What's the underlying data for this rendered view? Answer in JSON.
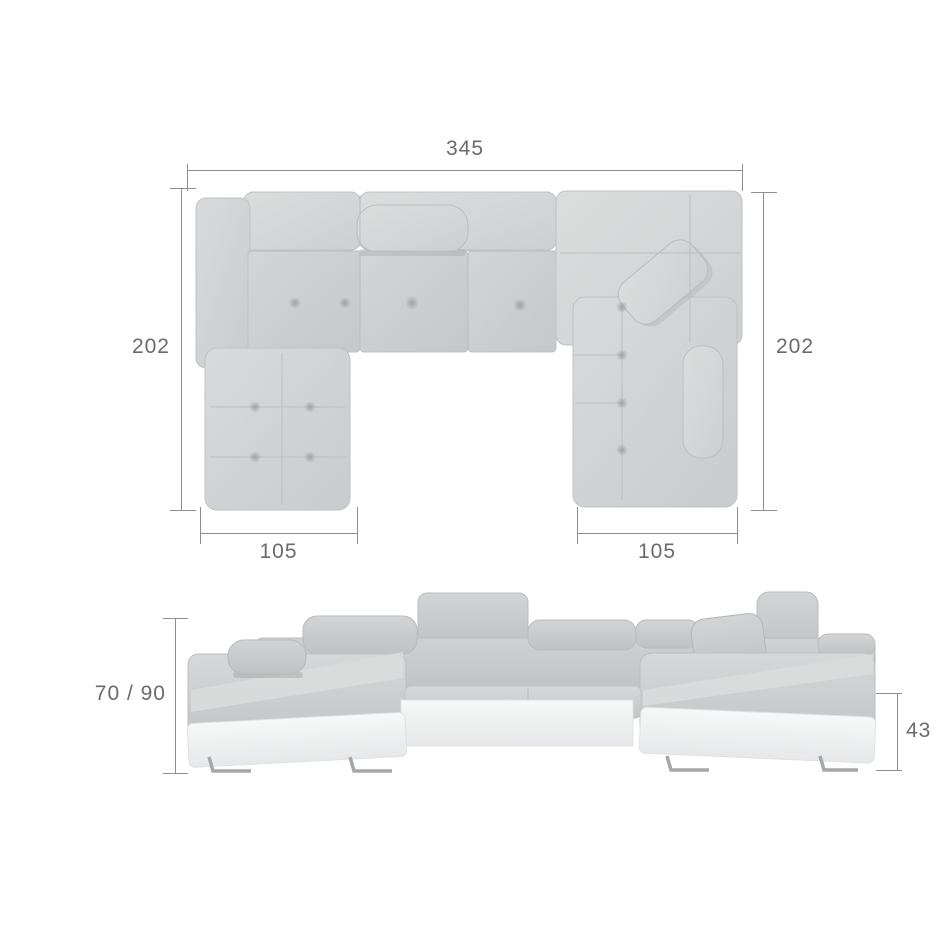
{
  "diagram": {
    "background": "#ffffff",
    "line_color": "#8d8d8d",
    "text_color": "#6b6b6b",
    "fabric_light": "#d8d9da",
    "fabric_mid": "#cdcfd1",
    "fabric_dark": "#c3c5c7",
    "base_white": "#f4f5f5",
    "leg_chrome": "#a5a8ab"
  },
  "dimensions": {
    "top_view": {
      "total_width": "345",
      "left_depth": "202",
      "right_depth": "202",
      "left_chaise_width": "105",
      "right_chaise_width": "105"
    },
    "front_view": {
      "backrest_height": "70 / 90",
      "seat_height": "43"
    }
  }
}
